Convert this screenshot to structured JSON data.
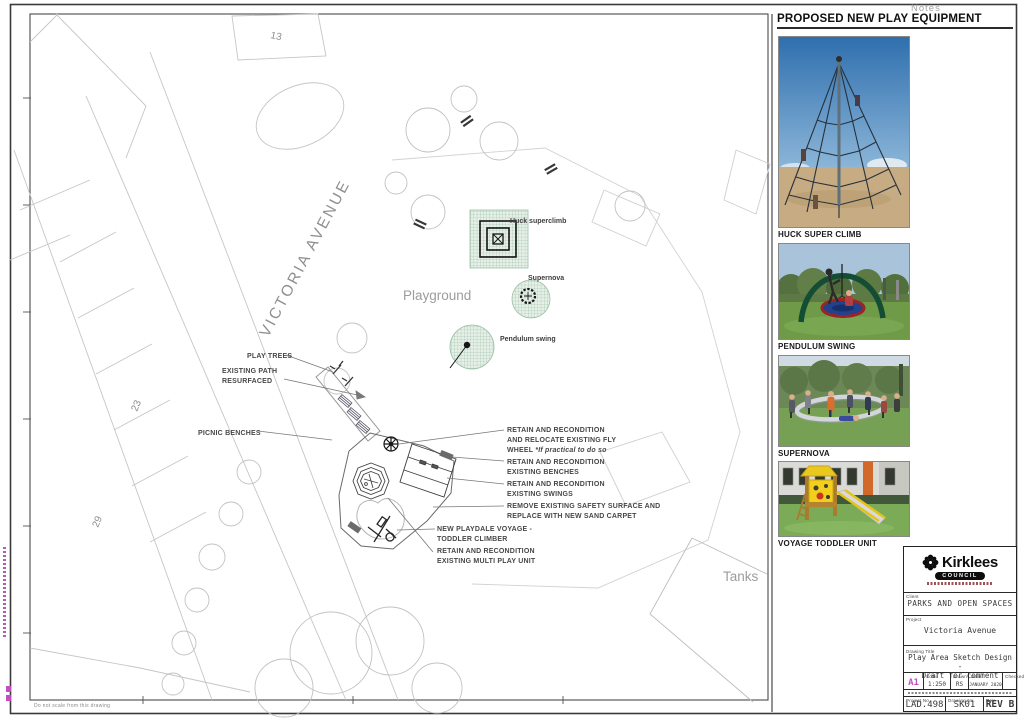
{
  "sheet": {
    "notes_label": "Notes",
    "footer_note": "Do not scale from this drawing"
  },
  "plan": {
    "street": "VICTORIA AVENUE",
    "area_label": "Playground",
    "tanks_label": "Tanks",
    "plots": {
      "n13": "13",
      "n23": "23",
      "n29": "29"
    },
    "equipment": {
      "huck": "Huck superclimb",
      "supernova": "Supernova",
      "pendulum": "Pendulum swing"
    },
    "callouts_left": {
      "play_trees": "PLAY TREES",
      "path_1": "EXISTING PATH",
      "path_2": "RESURFACED",
      "picnic": "PICNIC BENCHES"
    },
    "callouts_right": {
      "lines": [
        "RETAIN AND RECONDITION",
        "AND RELOCATE EXISTING FLY"
      ],
      "wheel_normal": "WHEEL ",
      "wheel_italic": "*If practical to do so",
      "lines2": [
        "RETAIN AND RECONDITION",
        "EXISTING BENCHES",
        "RETAIN AND RECONDITION",
        "EXISTING SWINGS",
        "REMOVE EXISTING SAFETY SURFACE AND",
        "REPLACE WITH NEW SAND CARPET"
      ]
    },
    "callouts_bottom": [
      "NEW PLAYDALE VOYAGE -",
      "TODDLER CLIMBER",
      "RETAIN AND RECONDITION",
      "EXISTING MULTI PLAY UNIT"
    ]
  },
  "equipment_panel": {
    "title": "PROPOSED NEW PLAY EQUIPMENT",
    "items": [
      {
        "label": "HUCK SUPER CLIMB"
      },
      {
        "label": "PENDULUM SWING"
      },
      {
        "label": "SUPERNOVA"
      },
      {
        "label": "VOYAGE TODDLER UNIT"
      }
    ]
  },
  "title_block": {
    "org_name": "Kirklees",
    "org_sub": "COUNCIL",
    "client_label": "Client",
    "client": "PARKS AND OPEN SPACES",
    "project_label": "Project",
    "project": "Victoria Avenue",
    "drawing_title_label": "Drawing Title",
    "drawing_title_1": "Play Area Sketch Design -",
    "drawing_title_2": "Draft for comment",
    "size": "A1",
    "scale_label": "Scale",
    "scale": "1:250",
    "drawn_label": "Drawn",
    "drawn": "RS",
    "date_label": "Date",
    "date": "JANUARY 2020",
    "checked_label": "Checked",
    "project_no_label": "Project No.",
    "project_no": "LAD.498",
    "drawing_no_label": "Drawing No.",
    "drawing_no": "SK01",
    "rev_label": "Rev",
    "rev": "REV B"
  }
}
